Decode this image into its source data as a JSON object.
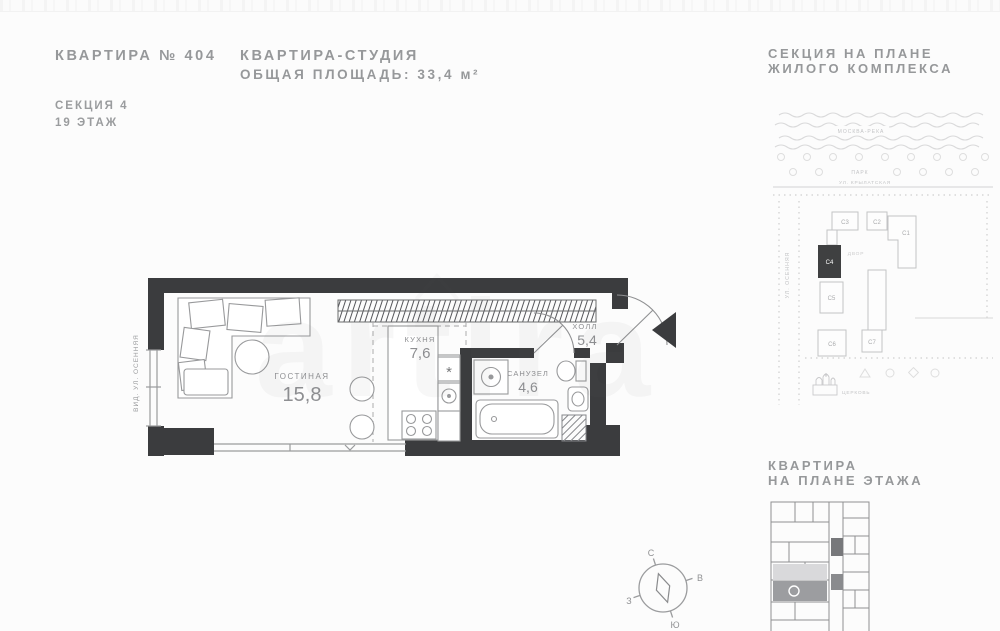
{
  "header": {
    "apartment_number": "КВАРТИРА № 404",
    "section": "СЕКЦИЯ 4",
    "floor": "19 ЭТАЖ",
    "apartment_type": "КВАРТИРА-СТУДИЯ",
    "total_area": "ОБЩАЯ ПЛОЩАДЬ: 33,4 м²"
  },
  "site_plan": {
    "title_line1": "СЕКЦИЯ НА ПЛАНЕ",
    "title_line2": "ЖИЛОГО КОМПЛЕКСА",
    "river_label": "МОСКВА-РЕКА",
    "park_label": "ПАРК",
    "street_top": "УЛ. КРЫЛАТСКАЯ",
    "street_left": "УЛ. ОСЕННЯЯ",
    "courtyard_label": "ДВОР",
    "church_label": "ЦЕРКОВЬ",
    "buildings": {
      "c1": "С1",
      "c2": "С2",
      "c3": "С3",
      "c4": "С4",
      "c5": "С5",
      "c6": "С6",
      "c7": "С7"
    },
    "highlighted_building": "С4",
    "highlight_color": "#3f4041"
  },
  "apartment_plan": {
    "street_view": "ВИД. УЛ. ОСЕННЯЯ",
    "living": {
      "name": "ГОСТИНАЯ",
      "area": "15,8"
    },
    "kitchen": {
      "name": "КУХНЯ",
      "area": "7,6"
    },
    "bathroom": {
      "name": "САНУЗЕЛ",
      "area": "4,6"
    },
    "hall": {
      "name": "ХОЛЛ",
      "area": "5,4"
    },
    "fridge_marker": "*",
    "wall_color": "#3b3c3e"
  },
  "floor_plan_panel": {
    "title_line1": "КВАРТИРА",
    "title_line2": "НА ПЛАНЕ ЭТАЖА"
  },
  "compass": {
    "north": "С",
    "south": "Ю",
    "east": "В",
    "west": "З"
  },
  "watermark": "artira"
}
